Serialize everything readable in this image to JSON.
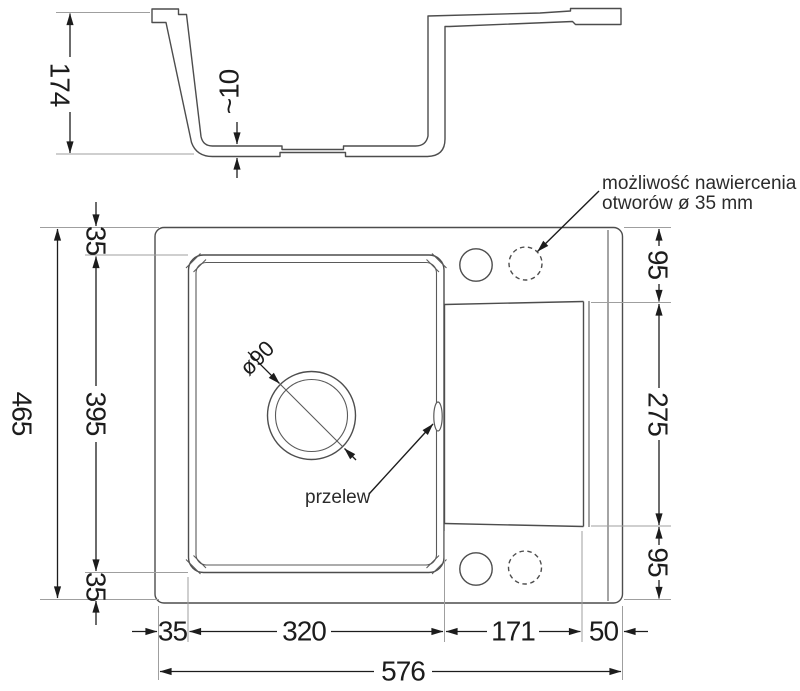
{
  "section_view": {
    "depth_label": "174",
    "bottom_thickness_label": "~10"
  },
  "plan_view": {
    "total_height": "465",
    "left_top": "35",
    "left_middle": "395",
    "left_bottom": "35",
    "right_top": "95",
    "right_middle": "275",
    "right_bottom": "95",
    "bottom_left_offset": "35",
    "bottom_bowl_width": "320",
    "bottom_drainer_width": "171",
    "bottom_right_offset": "50",
    "total_width": "576",
    "drain_diameter": "ø90"
  },
  "annotations": {
    "drill_note_line1": "możliwość nawiercenia",
    "drill_note_line2": "otworów ø 35 mm",
    "overflow_label": "przelew"
  },
  "colors": {
    "line": "#4d4d4d",
    "dimension": "#1c1c1c",
    "extension": "#9f9f9f",
    "background": "#ffffff"
  }
}
